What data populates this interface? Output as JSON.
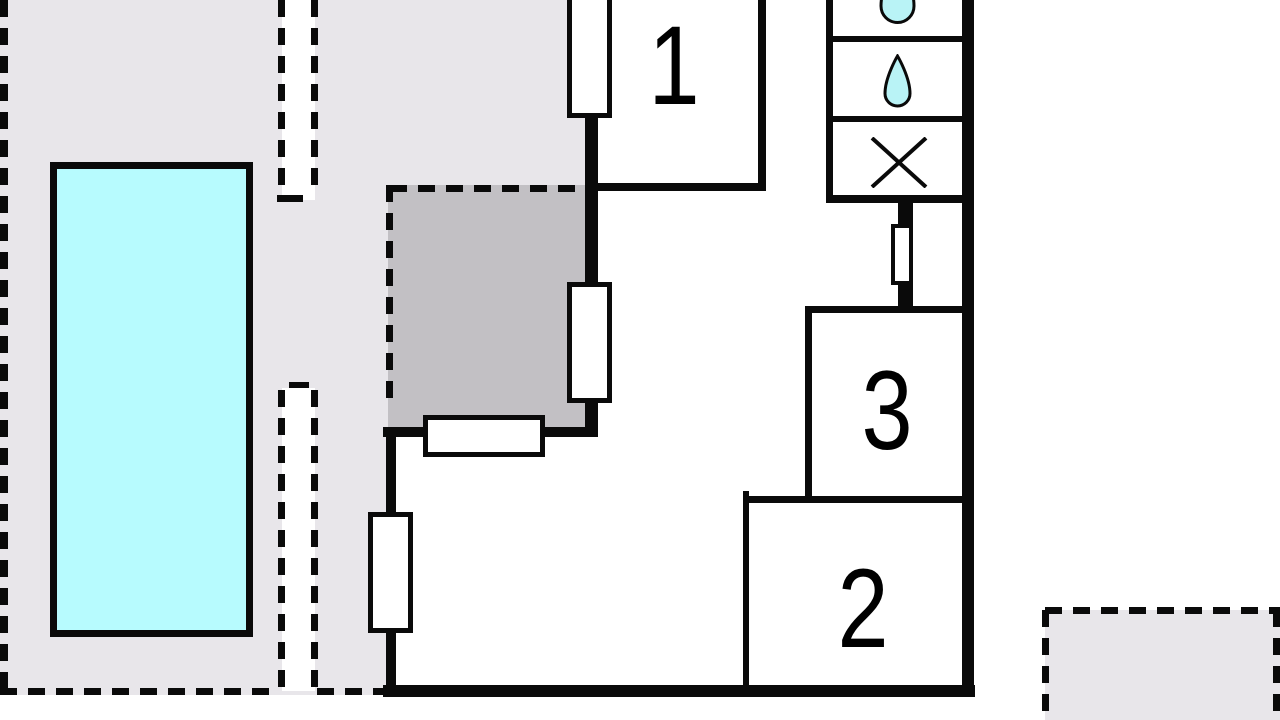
{
  "plan": {
    "kind": "floor-plan",
    "rooms": [
      {
        "number": "1"
      },
      {
        "number": "2"
      },
      {
        "number": "3"
      }
    ],
    "bathroom_fixture_icons": [
      "water-drop-partial-icon",
      "water-drop-icon",
      "cross-x-icon"
    ],
    "colors": {
      "background": "#ffffff",
      "wall": "#0a0a0a",
      "terrace_light": "#e8e6ea",
      "terrace_dark": "#c2c0c4",
      "pool": "#b7fbfe",
      "drop": "#b9f3f6"
    }
  }
}
